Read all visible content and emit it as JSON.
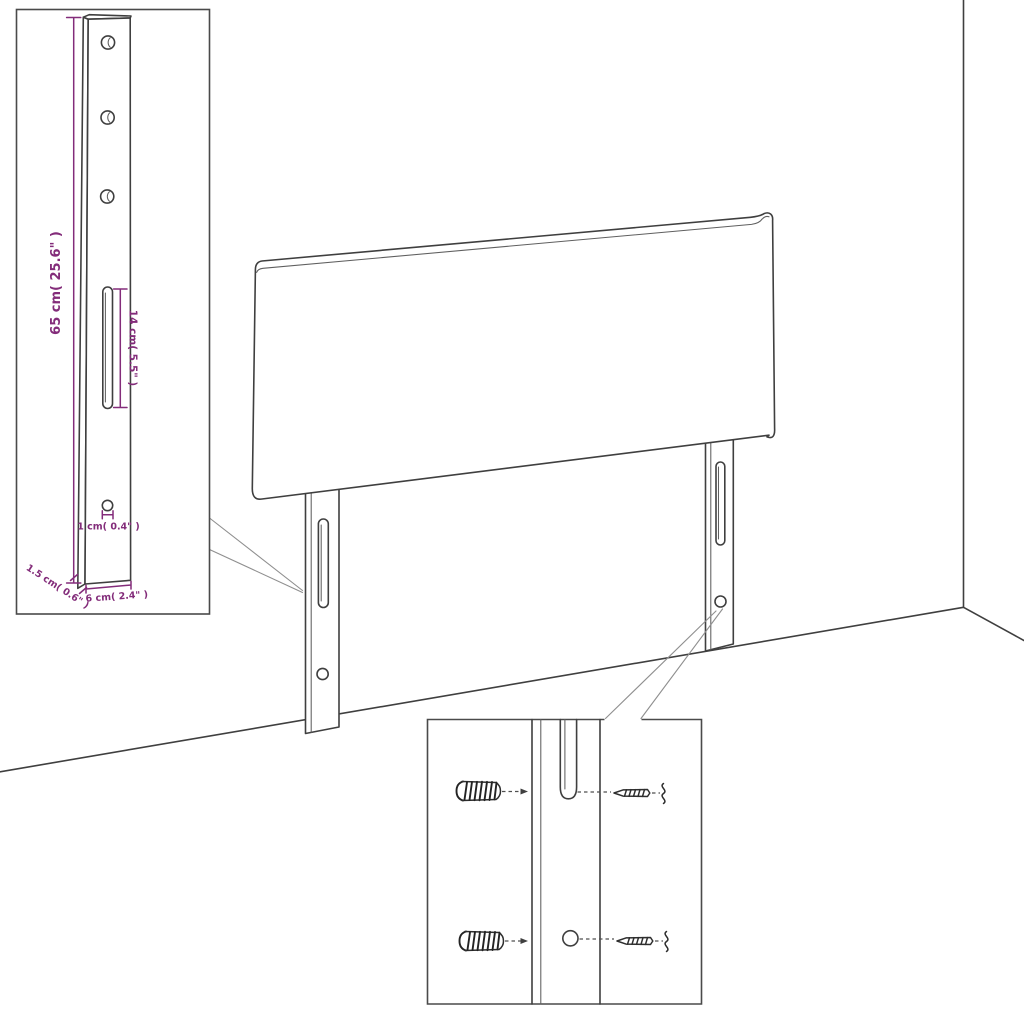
{
  "diagram": {
    "name": "headboard-mounting-dimension-diagram",
    "colors": {
      "background": "#ffffff",
      "line": "#3f3f3f",
      "thin_line": "#5f5f5f",
      "box_border": "#4a4a4a",
      "callout": "#8f8f8f",
      "dimension": "#832c7a"
    },
    "bracket_detail": {
      "height_label": "65 cm( 25.6\" )",
      "slot_label": "14 cm( 5.5\" )",
      "hole_label": "1 cm( 0.4\" )",
      "thickness_label": "1.5 cm( 0.6\" )",
      "width_label": "6 cm( 2.4\" )"
    }
  }
}
